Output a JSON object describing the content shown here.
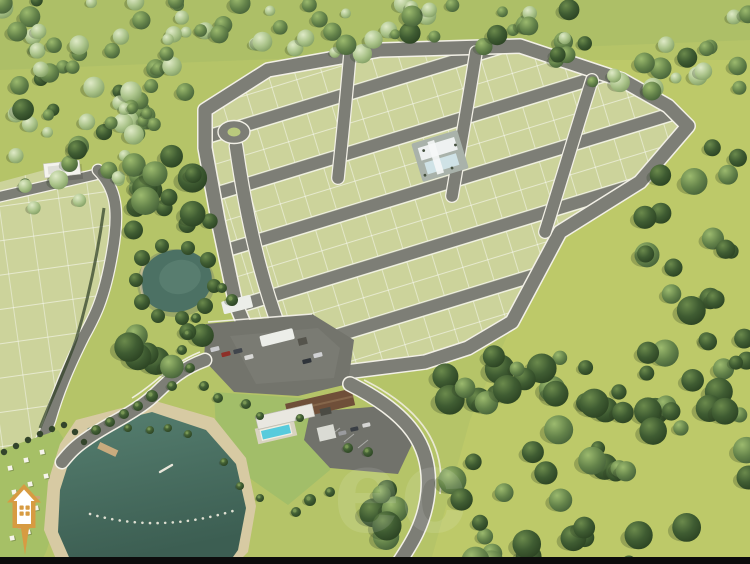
{
  "scene": {
    "title": "Aerial 3D render of a residential land development (loteamento) surrounded by forest",
    "watermark_text": "ec",
    "landmarks": {
      "main_subdivision": "Main grid of lots with internal streets and white curbs",
      "secondary_subdivision": "Partially visible lot grid on the left edge",
      "roundabout": "Small roundabout at the west corner of the grid",
      "community_center": "Amenity building on a central lot",
      "entrance_gate": "Gated entrance plaza with white canopies and parked cars",
      "clubhouse": "Clubhouse with brown roof, swimming pool and parking",
      "lake": "Lake with beach, buoy line, pier and lawn with umbrellas",
      "pond": "Small pond nested in the woods",
      "forest": "Dense native forest surrounding the development",
      "access_road": "Curved access roads leaving the gate with white fences and palm trees"
    },
    "colors": {
      "grass_base": "#b5c468",
      "lot_fill": "#ccd39b",
      "road": "#7d7e76",
      "curb": "#f6f5ec",
      "forest_dark": "#3a5530",
      "forest_light": "#9cb87c",
      "water_lake": "#46685c",
      "water_pond": "#4c7164",
      "sand": "#d7caa3",
      "pool": "#57cbdc",
      "roof_brown": "#6f4f39",
      "building_white": "#e9e7e0",
      "logo_orange": "#d79b42",
      "bottom_bar": "#0c0c0c"
    },
    "logo_name": "house-pin-logo"
  }
}
